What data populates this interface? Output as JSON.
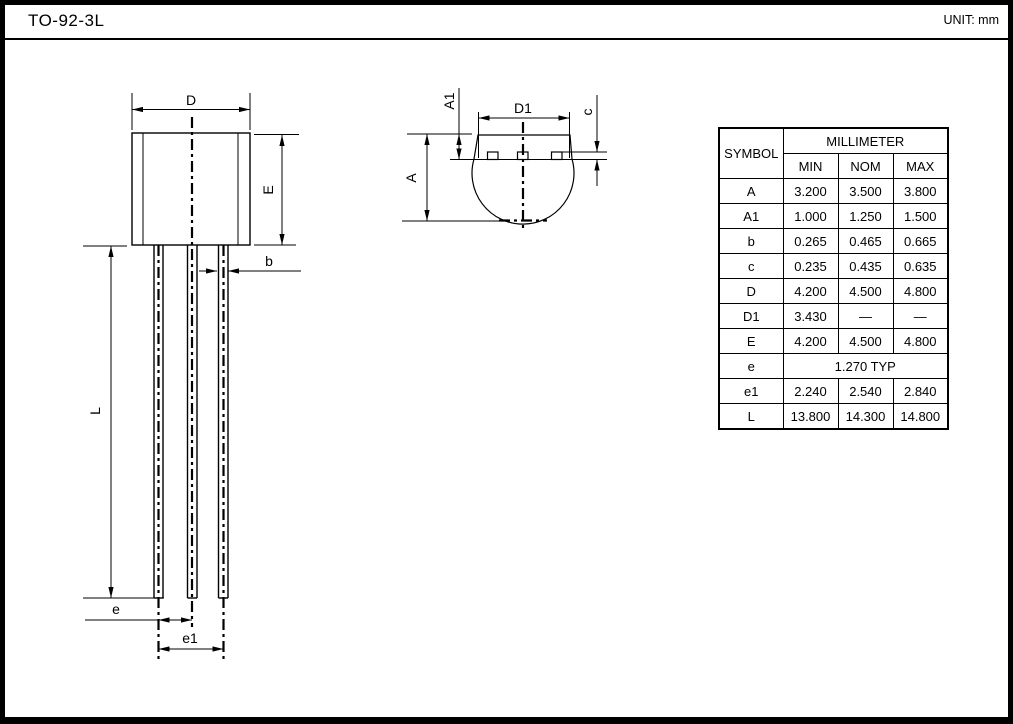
{
  "page": {
    "title": "TO-92-3L",
    "unit_label": "UNIT: mm"
  },
  "front_view": {
    "dim_labels": {
      "D": "D",
      "E": "E",
      "b": "b",
      "L": "L",
      "e": "e",
      "e1": "e1"
    }
  },
  "top_view": {
    "dim_labels": {
      "A": "A",
      "A1": "A1",
      "D1": "D1",
      "c": "c"
    }
  },
  "table": {
    "symbol_header": "SYMBOL",
    "unit_header": "MILLIMETER",
    "columns": [
      "MIN",
      "NOM",
      "MAX"
    ],
    "rows": [
      {
        "symbol": "A",
        "min": "3.200",
        "nom": "3.500",
        "max": "3.800"
      },
      {
        "symbol": "A1",
        "min": "1.000",
        "nom": "1.250",
        "max": "1.500"
      },
      {
        "symbol": "b",
        "min": "0.265",
        "nom": "0.465",
        "max": "0.665"
      },
      {
        "symbol": "c",
        "min": "0.235",
        "nom": "0.435",
        "max": "0.635"
      },
      {
        "symbol": "D",
        "min": "4.200",
        "nom": "4.500",
        "max": "4.800"
      },
      {
        "symbol": "D1",
        "min": "3.430",
        "nom": "—",
        "max": "—"
      },
      {
        "symbol": "E",
        "min": "4.200",
        "nom": "4.500",
        "max": "4.800"
      },
      {
        "symbol": "e",
        "span": "1.270 TYP"
      },
      {
        "symbol": "e1",
        "min": "2.240",
        "nom": "2.540",
        "max": "2.840"
      },
      {
        "symbol": "L",
        "min": "13.800",
        "nom": "14.300",
        "max": "14.800"
      }
    ]
  },
  "colors": {
    "ink": "#000000",
    "background": "#ffffff"
  }
}
